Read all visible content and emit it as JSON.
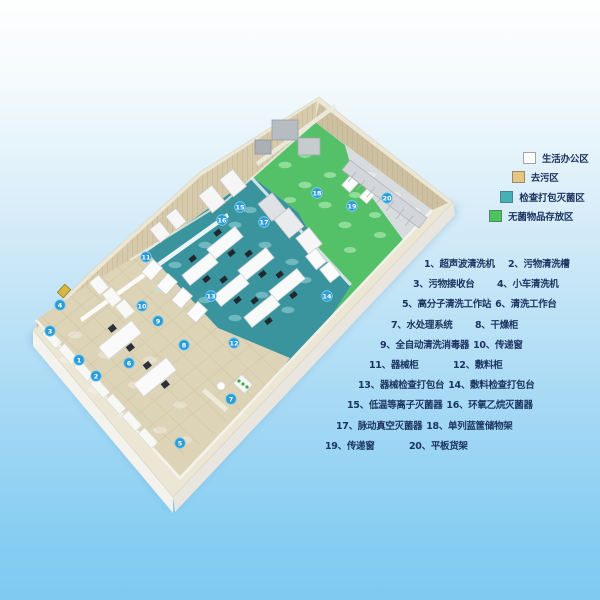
{
  "legend": {
    "items": [
      {
        "label": "生活办公区",
        "color": "#ffffff"
      },
      {
        "label": "去污区",
        "color": "#e6c684"
      },
      {
        "label": "检查打包灭菌区",
        "color": "#46b1b4"
      },
      {
        "label": "无菌物品存放区",
        "color": "#4bc45f"
      }
    ]
  },
  "equipment_list": {
    "items": [
      {
        "num": "1",
        "label": "超声波清洗机"
      },
      {
        "num": "2",
        "label": "污物清洗槽"
      },
      {
        "num": "3",
        "label": "污物接收台"
      },
      {
        "num": "4",
        "label": "小车清洗机"
      },
      {
        "num": "5",
        "label": "高分子清洗工作站"
      },
      {
        "num": "6",
        "label": "清洗工作台"
      },
      {
        "num": "7",
        "label": "水处理系统"
      },
      {
        "num": "8",
        "label": "干燥柜"
      },
      {
        "num": "9",
        "label": "全自动清洗消毒器"
      },
      {
        "num": "10",
        "label": "传递窗"
      },
      {
        "num": "11",
        "label": "器械柜"
      },
      {
        "num": "12",
        "label": "敷料柜"
      },
      {
        "num": "13",
        "label": "器械检查打包台"
      },
      {
        "num": "14",
        "label": "敷料检查打包台"
      },
      {
        "num": "15",
        "label": "低温等离子灭菌器"
      },
      {
        "num": "16",
        "label": "环氧乙烷灭菌器"
      },
      {
        "num": "17",
        "label": "脉动真空灭菌器"
      },
      {
        "num": "18",
        "label": "单列蓝筐储物架"
      },
      {
        "num": "19",
        "label": "传递窗"
      },
      {
        "num": "20",
        "label": "平板货架"
      }
    ]
  },
  "room": {
    "colors": {
      "wall_top": "#ece6d4",
      "wall_face_nw": "#d6caaa",
      "wall_face_ne": "#ccc0a0",
      "floor_base": "#d8dcde",
      "floor_decontamination": "#ddd3b6",
      "floor_inspection_sterilization": "#3a949e",
      "floor_sterile_storage": "#54c168",
      "floor_corridor": "#d8dcde",
      "marker": "#2d9bd5"
    },
    "markers": [
      {
        "n": "1",
        "x": 79,
        "y": 360
      },
      {
        "n": "2",
        "x": 96,
        "y": 376
      },
      {
        "n": "3",
        "x": 50,
        "y": 331
      },
      {
        "n": "4",
        "x": 60,
        "y": 305
      },
      {
        "n": "5",
        "x": 180,
        "y": 443
      },
      {
        "n": "6",
        "x": 129,
        "y": 363
      },
      {
        "n": "7",
        "x": 231,
        "y": 399
      },
      {
        "n": "8",
        "x": 184,
        "y": 345
      },
      {
        "n": "9",
        "x": 158,
        "y": 321
      },
      {
        "n": "10",
        "x": 142,
        "y": 306
      },
      {
        "n": "11",
        "x": 146,
        "y": 257
      },
      {
        "n": "12",
        "x": 234,
        "y": 343
      },
      {
        "n": "13",
        "x": 211,
        "y": 296
      },
      {
        "n": "14",
        "x": 327,
        "y": 296
      },
      {
        "n": "15",
        "x": 240,
        "y": 207
      },
      {
        "n": "16",
        "x": 222,
        "y": 220
      },
      {
        "n": "17",
        "x": 264,
        "y": 222
      },
      {
        "n": "18",
        "x": 317,
        "y": 193
      },
      {
        "n": "19",
        "x": 352,
        "y": 206
      },
      {
        "n": "20",
        "x": 387,
        "y": 198
      }
    ]
  }
}
